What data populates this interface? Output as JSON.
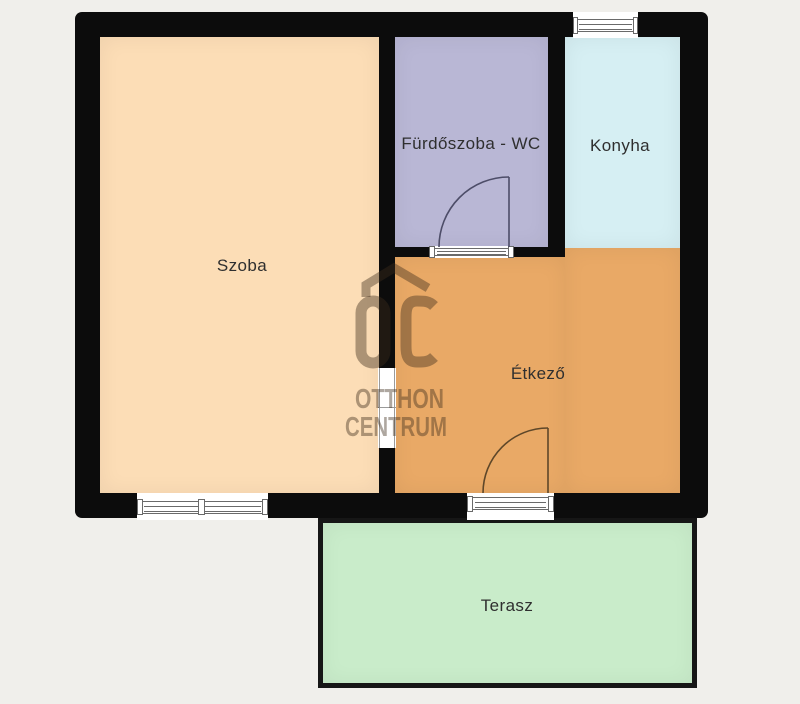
{
  "page": {
    "background": "#f0efeb"
  },
  "floorplan": {
    "wall_color": "#0c0c0c",
    "rooms": {
      "szoba": {
        "label": "Szoba",
        "color": "#fcddb6"
      },
      "furdoszoba": {
        "label": "Fürdőszoba - WC",
        "color": "#b9b7d5"
      },
      "konyha": {
        "label": "Konyha",
        "color": "#d6eff3"
      },
      "etkezo": {
        "label": "Étkező",
        "color": "#e9a966"
      },
      "terasz": {
        "label": "Terasz",
        "color": "#c9ecca"
      }
    },
    "doors": {
      "bathroom_door_color": "#4d4d68",
      "terrace_door_color": "#5e4729"
    },
    "watermark": {
      "monogram": "OC",
      "line1": "OTTHON",
      "line2": "CENTRUM",
      "color": "rgba(62,46,29,0.42)"
    }
  }
}
